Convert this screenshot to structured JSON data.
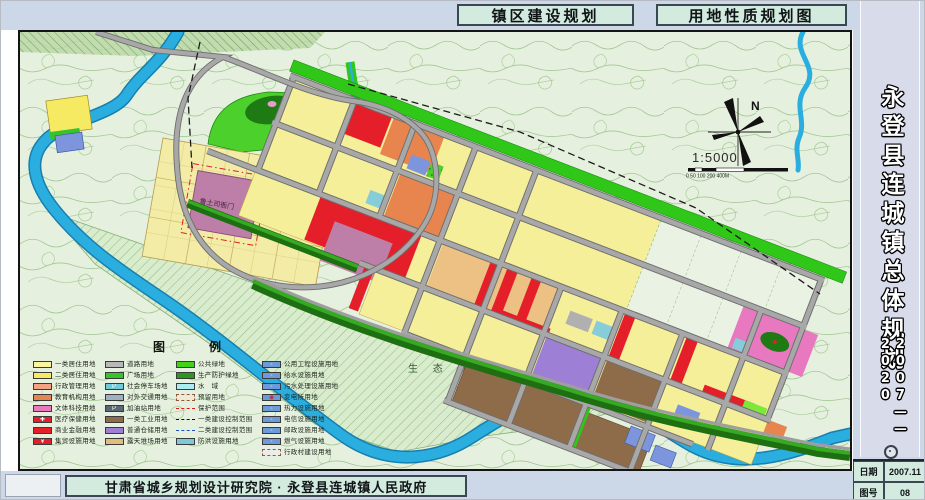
{
  "header": {
    "title_left": "镇区建设规划",
    "title_right": "用地性质规划图"
  },
  "sidebar": {
    "title_vertical": "永登县连城镇总体规划",
    "years": "2007——2020",
    "info_table": {
      "date_label": "日期",
      "date_value": "2007.11",
      "sheet_label": "图号",
      "sheet_value": "08"
    }
  },
  "footer": {
    "credit": "甘肃省城乡规划设计研究院 · 永登县连城镇人民政府"
  },
  "map": {
    "north_label": "N",
    "scale_text": "1:5000",
    "scale_bar_ticks": [
      "0",
      "50",
      "100",
      "200",
      "400M"
    ],
    "labels": {
      "eco_green": "生 态 绿 地",
      "heritage": "鲁土司衙门"
    }
  },
  "legend": {
    "title": "图　例",
    "columns": [
      {
        "items": [
          {
            "label": "一类居住用地",
            "color": "#fdf4a0",
            "type": "box"
          },
          {
            "label": "二类居住用地",
            "color": "#f6ea62",
            "type": "box"
          },
          {
            "label": "行政管理用地",
            "color": "#f2a383",
            "type": "box"
          },
          {
            "label": "教育机构用地",
            "color": "#e5854f",
            "type": "box"
          },
          {
            "label": "文体科技用地",
            "color": "#ea79bd",
            "type": "box"
          },
          {
            "label": "医疗保健用地",
            "color": "#e41f2a",
            "type": "box",
            "glyph": "✚"
          },
          {
            "label": "商业金融用地",
            "color": "#e41f2a",
            "type": "box"
          },
          {
            "label": "集贸设施用地",
            "color": "#e41f2a",
            "type": "box",
            "glyph": "¥"
          }
        ]
      },
      {
        "items": [
          {
            "label": "道路用地",
            "color": "#b8b8b8",
            "type": "box"
          },
          {
            "label": "广场用地",
            "color": "#37c32b",
            "type": "box"
          },
          {
            "label": "社会停车场地",
            "color": "#72cad9",
            "type": "box",
            "glyph": "P"
          },
          {
            "label": "对外交通用地",
            "color": "#9fb0c0",
            "type": "box"
          },
          {
            "label": "加油站用地",
            "color": "#5c6776",
            "type": "box",
            "glyph": "P"
          },
          {
            "label": "一类工业用地",
            "color": "#8f6c49",
            "type": "box"
          },
          {
            "label": "普通仓储用地",
            "color": "#9d80d6",
            "type": "box"
          },
          {
            "label": "露天堆场用地",
            "color": "#dfbd7d",
            "type": "box"
          }
        ]
      },
      {
        "items": [
          {
            "label": "公共绿地",
            "color": "#3fd215",
            "type": "box"
          },
          {
            "label": "生产防护绿地",
            "color": "#27991c",
            "type": "box"
          },
          {
            "label": "水　域",
            "color": "#a9ecf2",
            "type": "box"
          },
          {
            "label": "预留用地",
            "color": "#efead6",
            "type": "dashed-box"
          },
          {
            "label": "保护范围",
            "type": "line-red-dashdot"
          },
          {
            "label": "一类建设控制范围",
            "type": "line-black-dash"
          },
          {
            "label": "二类建设控制范围",
            "type": "line-blue-dash"
          },
          {
            "label": "防洪设施用地",
            "color": "#7cc9d8",
            "type": "box"
          }
        ]
      },
      {
        "items": [
          {
            "label": "公用工程设施用地",
            "color": "#6d9bd8",
            "type": "box",
            "glyph": "◦"
          },
          {
            "label": "给水设施用地",
            "color": "#6d9bd8",
            "type": "box",
            "glyph": "◦"
          },
          {
            "label": "污水处理设施用地",
            "color": "#6d9bd8",
            "type": "box",
            "glyph": "◦"
          },
          {
            "label": "变电所用地",
            "color": "#6d9bd8",
            "type": "box",
            "glyph": "◉",
            "glyph_color": "#e41f2a"
          },
          {
            "label": "热力设施用地",
            "color": "#6d9bd8",
            "type": "box",
            "glyph": "◦"
          },
          {
            "label": "电信设施用地",
            "color": "#6d9bd8",
            "type": "box",
            "glyph": "◦"
          },
          {
            "label": "邮政设施用地",
            "color": "#6d9bd8",
            "type": "box",
            "glyph": "◦"
          },
          {
            "label": "燃气设施用地",
            "color": "#6d9bd8",
            "type": "box",
            "glyph": "◦"
          },
          {
            "label": "行政村建设用地",
            "color": "#ececec",
            "type": "dashed-box"
          }
        ]
      }
    ]
  },
  "colors": {
    "band_background": "#ccd8e7",
    "panel_green": "#d3ebde",
    "sidebar_lavender": "#d8dbea",
    "map_background": "#e6f0de",
    "contour_green": "#9cc48e",
    "river_blue": "#2aaee0",
    "road_gray": "#9e9e9e",
    "public_green": "#2fc818",
    "residential_yellow": "#f6ef9a",
    "commercial_red": "#e41f2a",
    "industrial_brown": "#8f6c49",
    "warehouse_purple": "#9d80d6",
    "culture_pink": "#e878c0",
    "heritage_mauve": "#bd7fa8",
    "education_orange": "#e8854e",
    "utility_blue": "#6d9bd8"
  }
}
